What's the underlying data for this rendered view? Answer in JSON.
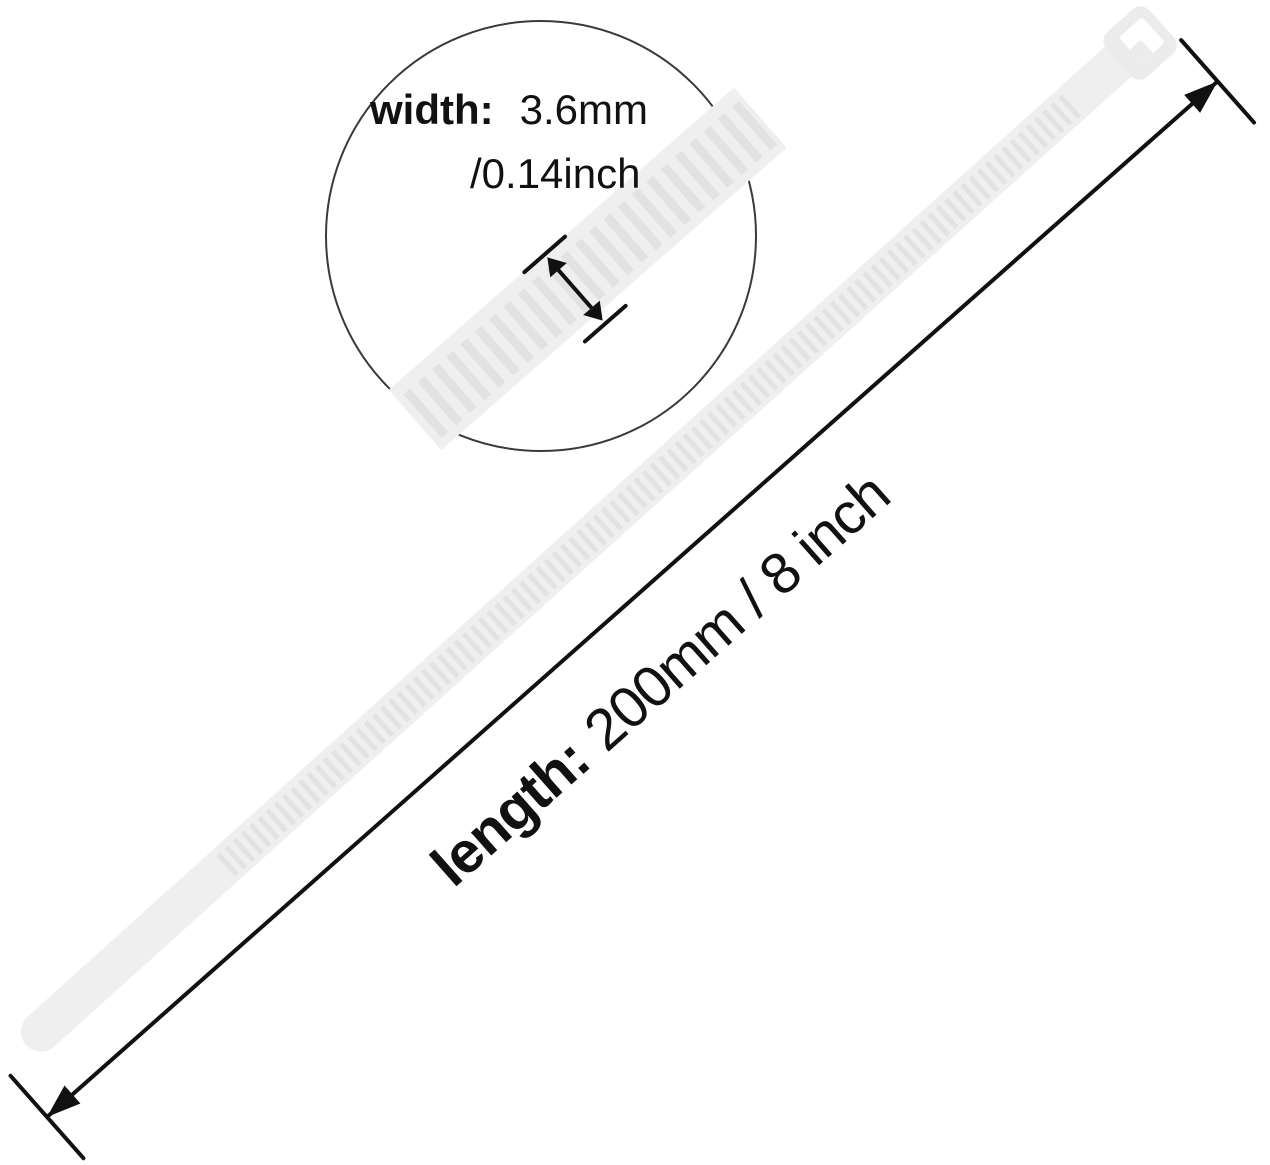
{
  "labels": {
    "width": {
      "title": "width:",
      "value": "3.6mm",
      "value_alt": "/0.14inch"
    },
    "length": {
      "title": "length:",
      "value": "200mm / 8 inch"
    }
  },
  "colors": {
    "background": "#ffffff",
    "band": "#efefef",
    "band_ridge": "#e2e2e2",
    "head": "#ececec",
    "slot": "#ffffff",
    "ink": "#111111",
    "circle_stroke": "#3a3a3a"
  }
}
